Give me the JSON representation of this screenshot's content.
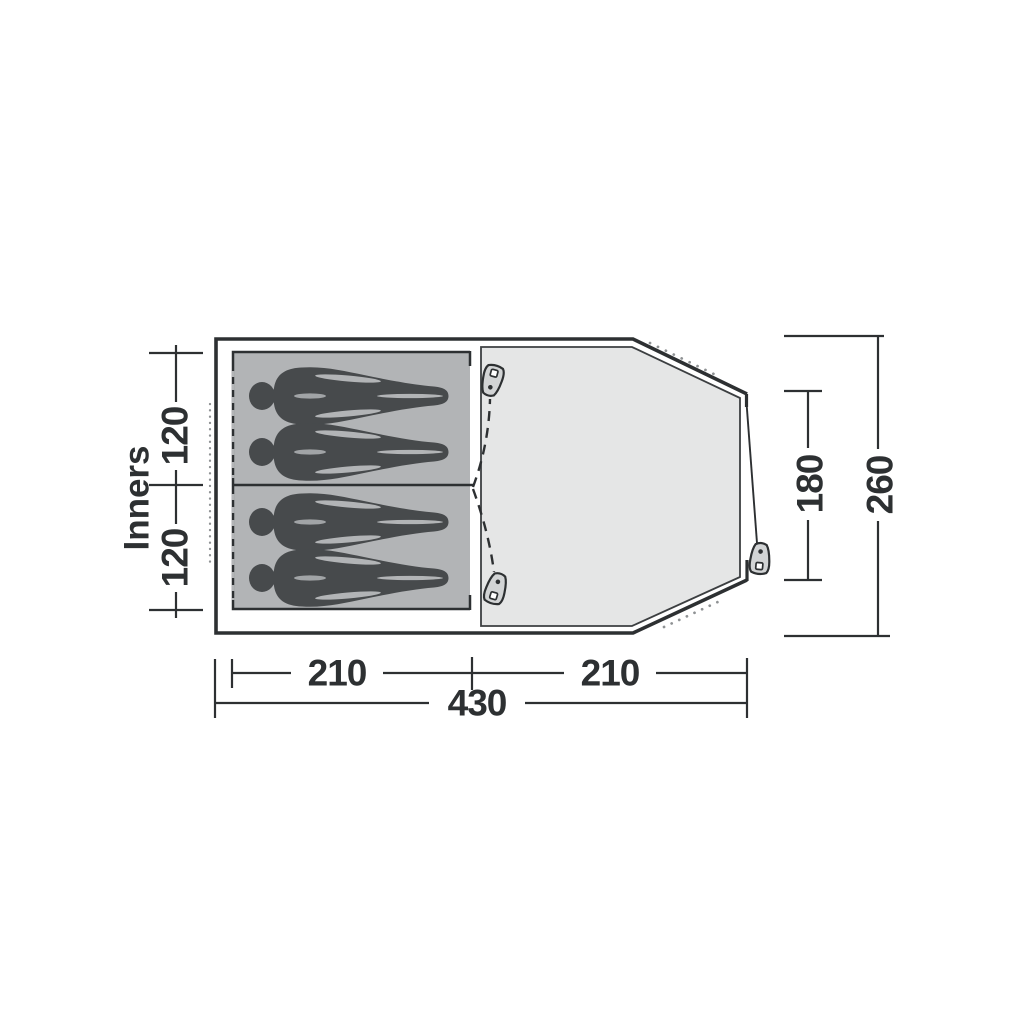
{
  "diagram": {
    "title": "Tent floorplan top view",
    "inners_label": "Inners",
    "dimensions": {
      "sleep_cabin_top_depth": "120",
      "sleep_cabin_bottom_depth": "120",
      "sleep_area_width": "210",
      "living_area_width": "210",
      "total_width": "430",
      "front_opening": "180",
      "total_depth": "260"
    },
    "occupant_count": 4,
    "colors": {
      "outline": "#2d3032",
      "inner_tent_fill": "#b2b4b6",
      "floor_fill": "#e5e6e6",
      "silhouette": "#474a4c",
      "zipper_pull_fill": "#d2d4d5",
      "dotted_guyline": "#8f9294",
      "background": "#ffffff"
    }
  }
}
